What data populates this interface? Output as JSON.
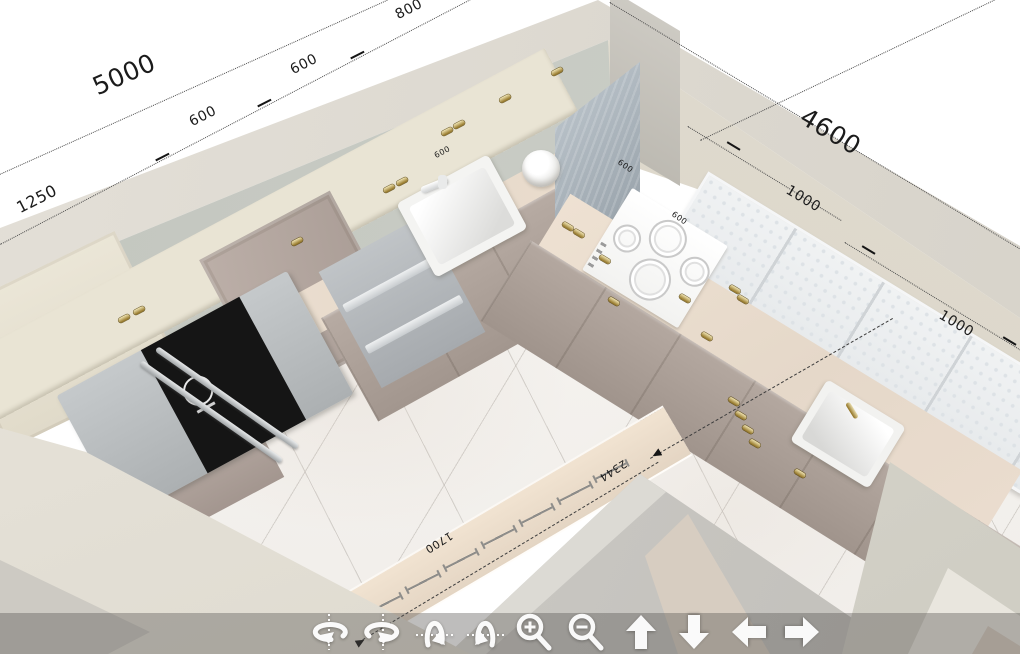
{
  "app": {
    "description": "3D kitchen planner viewport, top-down perspective view of an L-shaped kitchen with dimension annotations and view-navigation toolbar"
  },
  "dimensions": {
    "left_wall": {
      "total": "5000",
      "segments": [
        "1250",
        "600",
        "600",
        "800"
      ],
      "small": [
        "600"
      ]
    },
    "right_wall": {
      "total": "4600",
      "segments": [
        "1000",
        "1000"
      ],
      "small": [
        "600",
        "600"
      ]
    },
    "window": {
      "width": "1700",
      "diagonal": "2344"
    }
  },
  "toolbar": {
    "icons": [
      {
        "name": "orbit-left-icon"
      },
      {
        "name": "orbit-right-icon"
      },
      {
        "name": "tilt-up-icon"
      },
      {
        "name": "tilt-down-icon"
      },
      {
        "name": "zoom-in-icon"
      },
      {
        "name": "zoom-out-icon"
      },
      {
        "name": "pan-up-icon"
      },
      {
        "name": "pan-down-icon"
      },
      {
        "name": "pan-left-icon"
      },
      {
        "name": "pan-right-icon"
      }
    ]
  },
  "colors": {
    "background": "#ffffff",
    "wall_top": "#dedad2",
    "wall_left_face": "#c6c9c2",
    "wall_right_face": "#ddd8cc",
    "floor": "#f5f3f0",
    "upper_cabinet": "#eae5d6",
    "tall_cabinet": "#b1a49d",
    "base_cabinet": "#b0a49c",
    "countertop": "#e9ddcf",
    "appliance_gray": "#b7bbbe",
    "fridge_glass_black": "#151515",
    "glass_cabinet": "#edeff0",
    "handle_gold": "#8d6e1e",
    "dimension_text": "#1b1b1b"
  }
}
